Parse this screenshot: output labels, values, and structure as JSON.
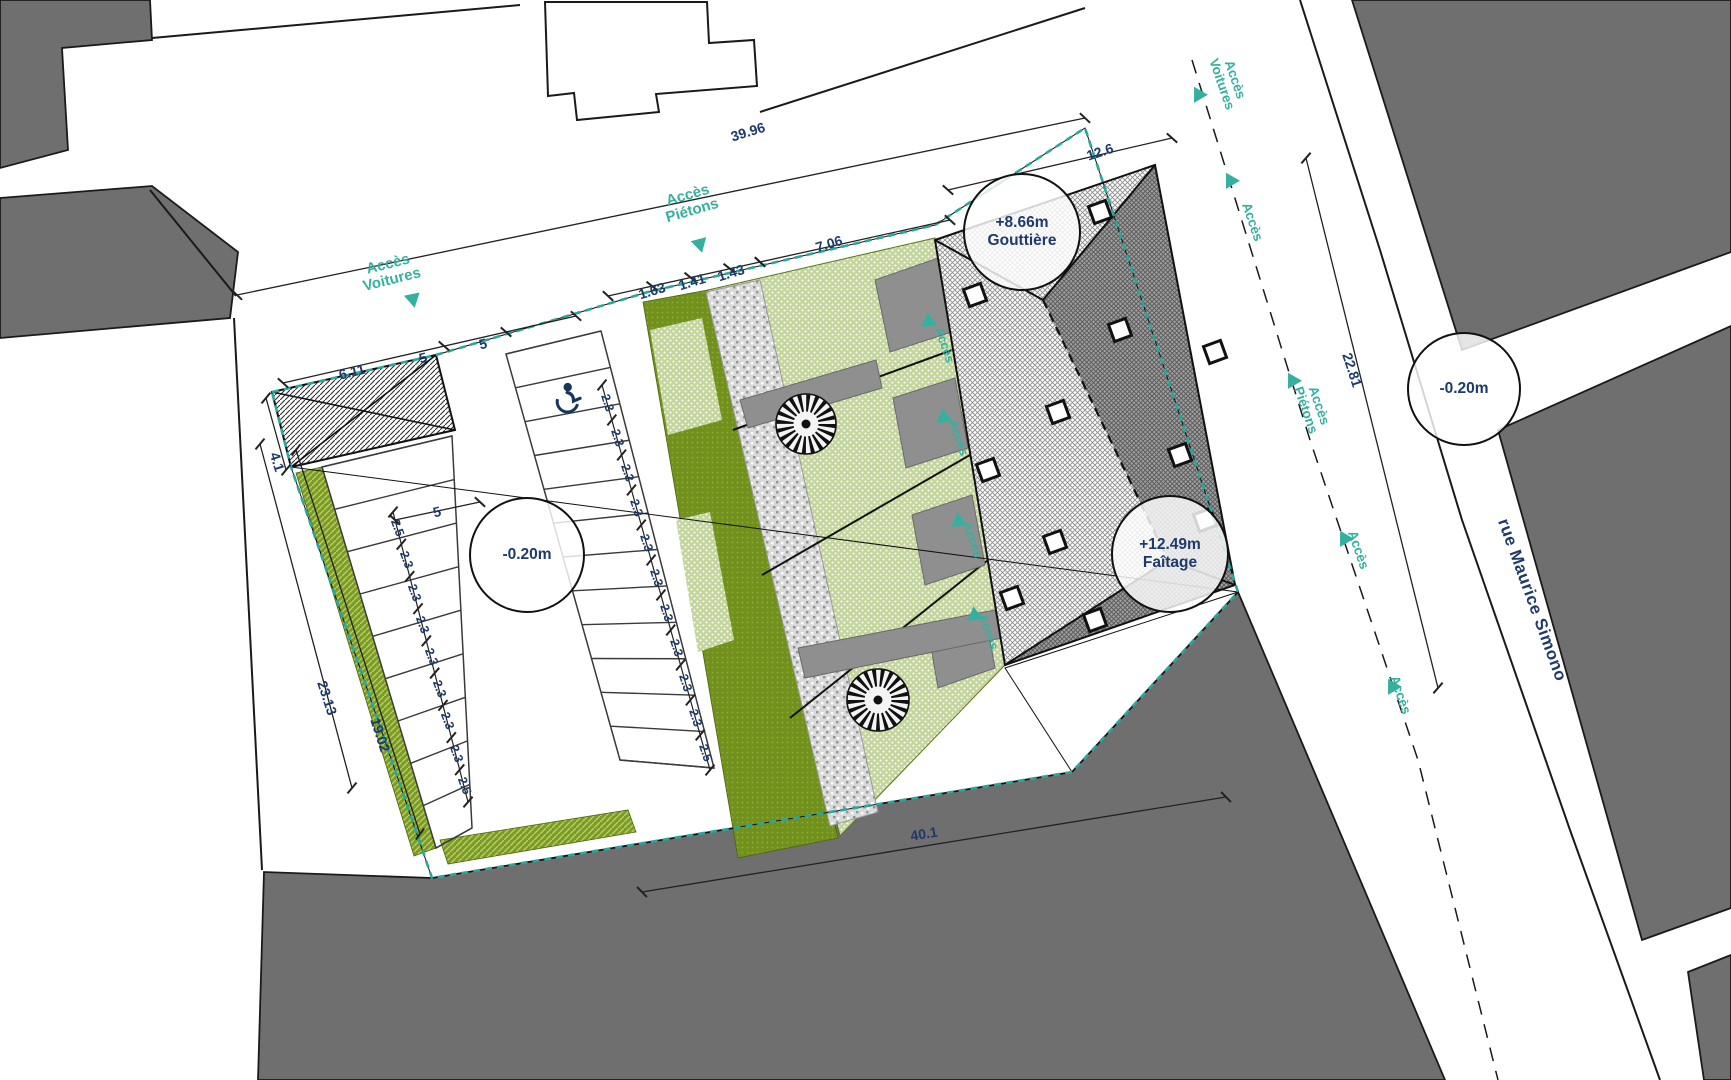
{
  "labels": [
    {
      "text": "39.96",
      "name": "dim-overall-top"
    },
    {
      "text": "12.6",
      "name": "dim-building-front"
    },
    {
      "text": "1.63",
      "name": "dim-garden-strip-1"
    },
    {
      "text": "1.41",
      "name": "dim-garden-strip-2"
    },
    {
      "text": "1.43",
      "name": "dim-garden-strip-3"
    },
    {
      "text": "7.06",
      "name": "dim-house-width"
    },
    {
      "text": "6.11",
      "name": "dim-shelter-width"
    },
    {
      "text": "5",
      "name": "dim-depth-a"
    },
    {
      "text": "5",
      "name": "dim-depth-b"
    },
    {
      "text": "5",
      "name": "dim-depth-c"
    },
    {
      "text": "4.1",
      "name": "dim-shelter-depth"
    },
    {
      "text": "22.81",
      "name": "dim-street-frontage"
    },
    {
      "text": "40.1",
      "name": "dim-bottom-width"
    },
    {
      "text": "23.13",
      "name": "dim-left-edge-a"
    },
    {
      "text": "19.02",
      "name": "dim-left-edge-b"
    },
    {
      "text": "Accès\nVoitures",
      "name": "access-cars-top-left"
    },
    {
      "text": "Accès\nPiétons",
      "name": "access-pedestrians-top"
    },
    {
      "text": "Accès\nVoitures",
      "name": "access-cars-street"
    },
    {
      "text": "Accès",
      "name": "access-street-1"
    },
    {
      "text": "Accès\nPiétons",
      "name": "access-pedestrians-street"
    },
    {
      "text": "Accès",
      "name": "access-street-2"
    },
    {
      "text": "Accès",
      "name": "access-street-3"
    },
    {
      "text": "Accès",
      "name": "access-unit-1"
    },
    {
      "text": "Accès",
      "name": "access-unit-2"
    },
    {
      "text": "Accès",
      "name": "access-unit-3"
    },
    {
      "text": "Accès",
      "name": "access-unit-4"
    }
  ],
  "parking": {
    "left_chain": [
      "2.5",
      "2.3",
      "2.3",
      "2.3",
      "2.3",
      "2.3",
      "2.3",
      "2.3",
      "2.5"
    ],
    "mid_chain": [
      "2.3",
      "2.3",
      "2.3",
      "2.3",
      "2.3",
      "2.3",
      "2.3",
      "2.3",
      "2.3",
      "2.3",
      "2.5"
    ]
  },
  "levels": [
    {
      "value": "-0.20m",
      "label": ""
    },
    {
      "value": "-0.20m",
      "label": ""
    },
    {
      "value": "+8.66m",
      "label": "Gouttière"
    },
    {
      "value": "+12.49m",
      "label": "Faîtage"
    }
  ],
  "street": {
    "name": "rue Maurice Simono"
  },
  "colors": {
    "accent_teal": "#35b0a0",
    "dim_text": "#1d3a6a",
    "context_gray": "#6f6f6f",
    "lawn_green": "#c3d49c",
    "hedge_green": "#71901c"
  }
}
